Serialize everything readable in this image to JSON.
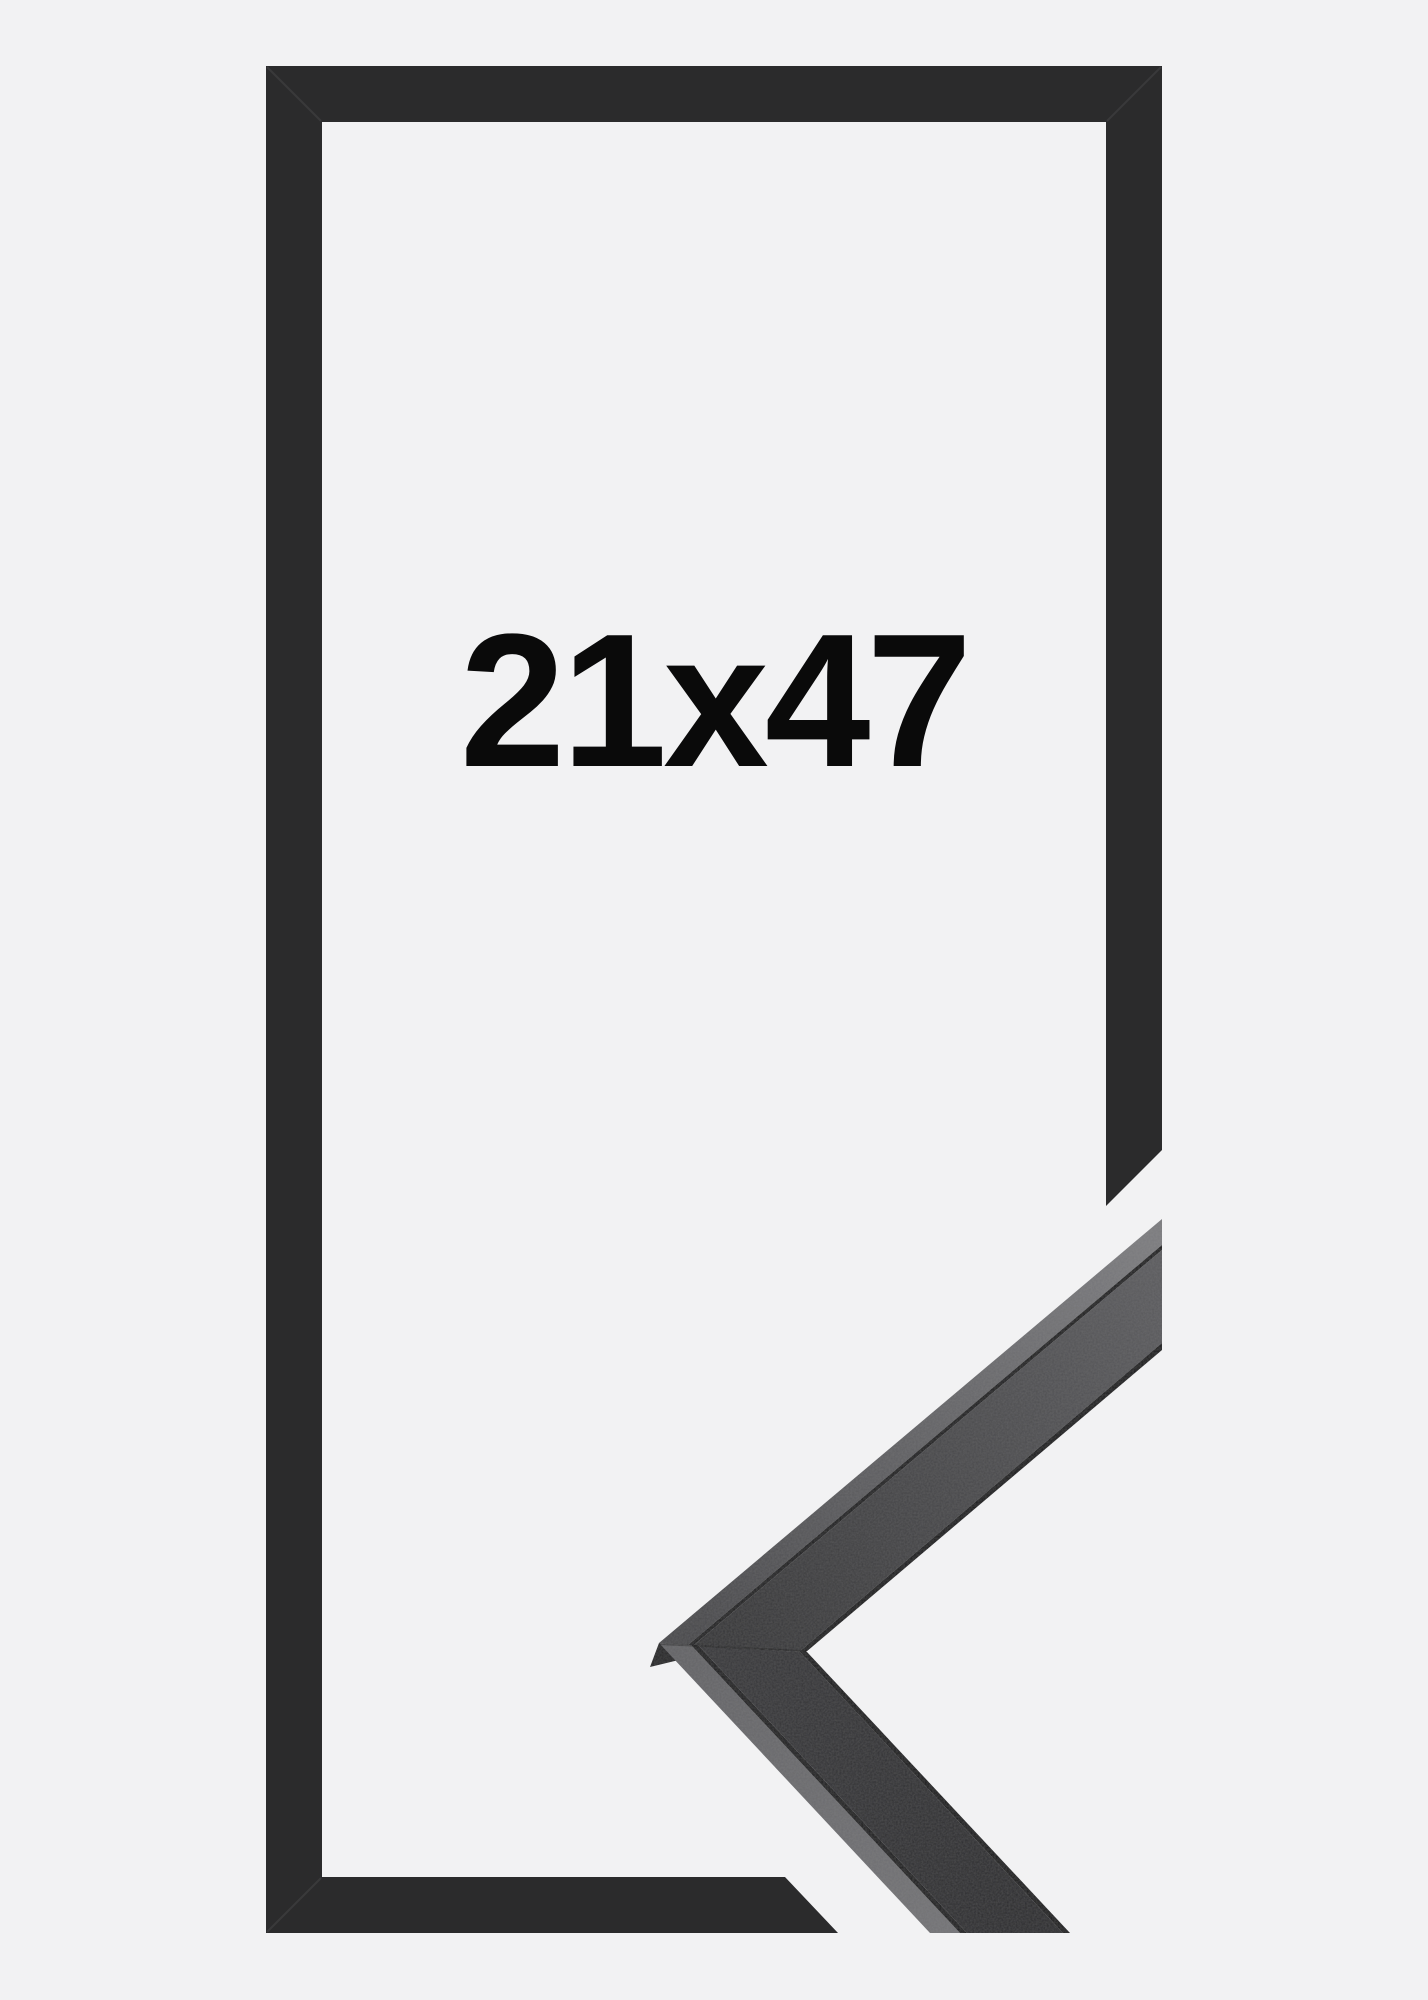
{
  "product": {
    "size_label": "21x47"
  },
  "colors": {
    "background": "#f2f2f3",
    "frame": "#2b2b2c",
    "label_text": "#0a0a0a",
    "seam_dark": "#161618",
    "lip_dark": "#121214",
    "apex_side": "#1e1e20",
    "frame_mitre_seam": "rgba(255,255,255,0.07)",
    "moulding_mitre_seam": "rgba(0,0,0,0.30)"
  },
  "figure": {
    "width": 1428,
    "height": 2000,
    "gradients": [
      {
        "id": "gUpStripe",
        "x1": 700,
        "y1": 1640,
        "x2": 1162,
        "y2": 1260,
        "stops": [
          [
            "0",
            "#47474a"
          ],
          [
            "1",
            "#7a7a7d"
          ]
        ]
      },
      {
        "id": "gUpFace",
        "x1": 700,
        "y1": 1650,
        "x2": 1162,
        "y2": 1300,
        "stops": [
          [
            "0",
            "#313133"
          ],
          [
            "1",
            "#59595c"
          ]
        ]
      },
      {
        "id": "gBtStripe",
        "x1": 680,
        "y1": 1650,
        "x2": 1000,
        "y2": 1933,
        "stops": [
          [
            "0",
            "#626265"
          ],
          [
            "1",
            "#737376"
          ]
        ]
      },
      {
        "id": "gBtFace",
        "x1": 690,
        "y1": 1650,
        "x2": 1020,
        "y2": 1933,
        "stops": [
          [
            "0",
            "#353538"
          ],
          [
            "1",
            "#28282b"
          ]
        ]
      }
    ],
    "shapes": [
      {
        "layer": "flat",
        "name": "flat-frame-outline",
        "fill": "@frame",
        "points": "266,66 1162,66 1162,1150 1106,1206 1106,122 322,122 322,1877 785,1877 838,1933 266,1933"
      },
      {
        "layer": "moulding",
        "name": "moulding-apex-side-face",
        "fill": "@apex_side",
        "points": "659,1643 650,1667 683,1659"
      },
      {
        "layer": "moulding",
        "name": "moulding-top-arm-outer-face",
        "fill": "url(#gUpStripe)",
        "points": "659,1643 1162,1219 1162,1245 688,1645"
      },
      {
        "layer": "moulding",
        "name": "moulding-top-arm-seam",
        "fill": "@seam_dark",
        "points": "688,1645 1162,1245 1162,1250 694,1645"
      },
      {
        "layer": "moulding",
        "name": "moulding-top-arm-front-face",
        "fill": "url(#gUpFace)",
        "points": "694,1645 1162,1250 1162,1343 799,1652"
      },
      {
        "layer": "moulding",
        "name": "moulding-top-arm-inner-lip",
        "fill": "@lip_dark",
        "points": "799,1652 1162,1343 1162,1350 806,1652"
      },
      {
        "layer": "moulding",
        "name": "moulding-bottom-arm-outer-face",
        "fill": "url(#gBtStripe)",
        "points": "659,1643 930,1933 960,1933 691,1645"
      },
      {
        "layer": "moulding",
        "name": "moulding-bottom-arm-seam",
        "fill": "@seam_dark",
        "points": "691,1645 960,1933 967,1933 698,1645"
      },
      {
        "layer": "moulding",
        "name": "moulding-bottom-arm-front-face",
        "fill": "url(#gBtFace)",
        "points": "698,1645 967,1933 1063,1933 800,1652"
      },
      {
        "layer": "moulding",
        "name": "moulding-bottom-arm-inner-lip",
        "fill": "@lip_dark",
        "points": "800,1652 1063,1933 1070,1933 807,1652"
      }
    ],
    "lines": [
      {
        "layer": "flat",
        "name": "frame-mitre-seam-top-left",
        "x1": 267,
        "y1": 67,
        "x2": 321,
        "y2": 121,
        "stroke": "@frame_mitre_seam",
        "width": 2
      },
      {
        "layer": "flat",
        "name": "frame-mitre-seam-top-right",
        "x1": 1161,
        "y1": 67,
        "x2": 1107,
        "y2": 121,
        "stroke": "@frame_mitre_seam",
        "width": 2
      },
      {
        "layer": "flat",
        "name": "frame-mitre-seam-bottom-left",
        "x1": 267,
        "y1": 1932,
        "x2": 321,
        "y2": 1878,
        "stroke": "@frame_mitre_seam",
        "width": 2
      },
      {
        "layer": "moulding",
        "name": "moulding-mitre-seam",
        "x1": 659,
        "y1": 1644,
        "x2": 806,
        "y2": 1651,
        "stroke": "@moulding_mitre_seam",
        "width": 2
      }
    ],
    "label": {
      "x": 714,
      "y": 766,
      "font_size": 190
    }
  }
}
